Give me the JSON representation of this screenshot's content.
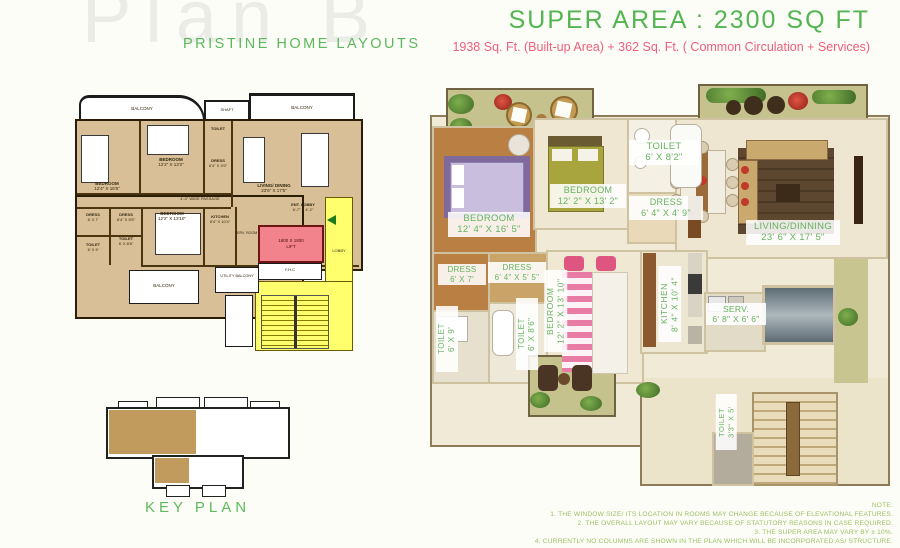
{
  "header": {
    "watermark": "Plan B",
    "brand": "PRISTINE HOME LAYOUTS",
    "super_area": "SUPER AREA : 2300  SQ FT",
    "area_breakdown": "1938 Sq. Ft. (Built-up Area) + 362 Sq. Ft. ( Common Circulation + Services)"
  },
  "left_plan": {
    "balcony_top_left": "BALCONY",
    "shaft": "SHAFT",
    "balcony_top_right": "BALCONY",
    "bedroom1": {
      "name": "BEDROOM",
      "dims": "12'4\" X 16'5\""
    },
    "bedroom2": {
      "name": "BEDROOM",
      "dims": "12'2\" X 13'2\""
    },
    "toilet_top": {
      "name": "TOILET"
    },
    "dress_top": {
      "name": "DRESS",
      "dims": "6'4\" X 4'9\""
    },
    "living": {
      "name": "LIVING/ DINING",
      "dims": "23'6\" X 17'5\""
    },
    "passage": "4'-0\" WIDE PASSAGE",
    "dress_left": {
      "name": "DRESS",
      "dims": "6' X 7'"
    },
    "dress_mid": {
      "name": "DRESS",
      "dims": "6'4\" X 5'5\""
    },
    "bedroom3": {
      "name": "BEDROOM",
      "dims": "12'2\" X 13'10\""
    },
    "kitchen": {
      "name": "KITCHEN",
      "dims": "8'4\" X 10'4\""
    },
    "toilet_left": {
      "name": "TOILET",
      "dims": "6' X 9'"
    },
    "toilet_mid": {
      "name": "TOILET",
      "dims": "6' X 8'6\""
    },
    "balcony_bottom": "BALCONY",
    "utility_balcony": "UTILITY BALCONY",
    "ent_lobby": {
      "name": "ENT. LOBBY",
      "dims": "6'-7\" X 4'-2\""
    },
    "serv_room": "SERV. ROOM",
    "lift_line1": "1800 X 1800",
    "lift_line2": "LIFT",
    "lobby": "LOBBY",
    "fhc": "F.H.C"
  },
  "key_plan": {
    "caption": "KEY PLAN"
  },
  "rendered_plan": {
    "bedroom1": {
      "name": "BEDROOM",
      "dims": "12' 4\" X 16' 5\""
    },
    "bedroom2": {
      "name": "BEDROOM",
      "dims": "12' 2\" X 13' 2\""
    },
    "toilet_top": {
      "name": "TOILET",
      "dims": "6' X 8'2\""
    },
    "dress_top": {
      "name": "DRESS",
      "dims": "6' 4\" X 4' 9\""
    },
    "living": {
      "name": "LIVING/DINNING",
      "dims": "23' 6\" X 17' 5\""
    },
    "dress_left": {
      "name": "DRESS",
      "dims": "6' X 7'"
    },
    "dress_mid": {
      "name": "DRESS",
      "dims": "6' 4\" X 5' 5\""
    },
    "toilet_left": {
      "name": "TOILET",
      "dims": "6' X 9'"
    },
    "toilet_mid": {
      "name": "TOILET",
      "dims": "6' X 8'6\""
    },
    "bedroom3": {
      "name": "BEDROOM",
      "dims": "12' 2\" X 13' 10\""
    },
    "kitchen": {
      "name": "KITCHEN",
      "dims": "8' 4\" X 10' 4\""
    },
    "serv": {
      "name": "SERV.",
      "dims": "6' 8\" X 6' 6\""
    },
    "toilet_small": {
      "name": "TOILET",
      "dims": "3'3\" X 5'"
    }
  },
  "notes": {
    "title": "NOTE:",
    "lines": [
      "1. THE WINDOW SIZE/ ITS LOCATION IN ROOMS MAY CHANGE BECAUSE OF ELEVATIONAL FEATURES.",
      "2. THE OVERALL LAYOUT MAY VARY BECAUSE OF STATUTORY REASONS IN CASE REQUIRED.",
      "3. THE SUPER AREA MAY VARY BY ± 10%.",
      "4. CURRENTLY NO COLUMNS ARE SHOWN IN THE PLAN WHICH WILL BE INCORPORATED AS/ STRUCTURE."
    ]
  },
  "colors": {
    "accent_green": "#5cb85c",
    "accent_pink": "#ee5e7d",
    "note_green": "#9cbf62",
    "lobby_yellow": "#ffff6e",
    "lift_pink": "#f2838d",
    "plan_tan": "#d8bf97",
    "keyplan_tan": "#c19a5e"
  }
}
